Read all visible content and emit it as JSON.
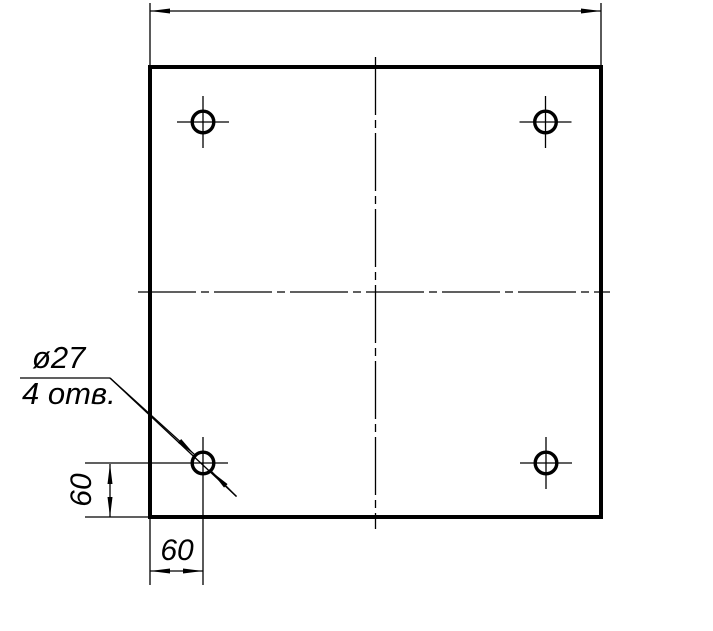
{
  "drawing": {
    "type": "technical-drawing",
    "background": "#ffffff",
    "line_color": "#000000",
    "labels": {
      "hole_diameter": "ø27",
      "hole_count": "4 отв.",
      "dim_left": "60",
      "dim_bottom": "60"
    },
    "part": {
      "hole_count": 4,
      "hole_diameter_mm": 27,
      "hole_offset_from_edge_mm": 60
    }
  }
}
